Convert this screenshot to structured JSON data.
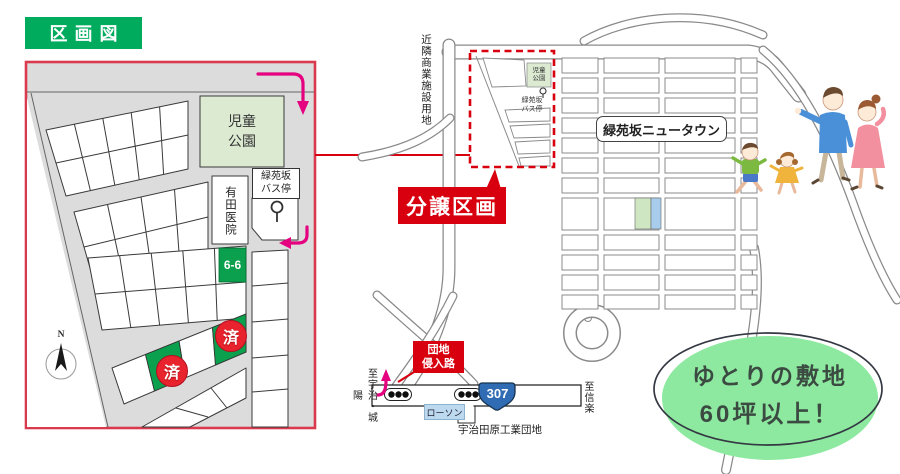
{
  "badge": {
    "label": "区画図"
  },
  "lot_map": {
    "park": "児童\n公園",
    "bus_stop": "緑苑坂\nバス停",
    "clinic": "有田医院",
    "lot_number": "6-6",
    "sold": "済",
    "compass_n": "N"
  },
  "area_map": {
    "commercial_land": "近隣商業施設用地",
    "park_small": "児童\n公園",
    "bus_stop_small": "緑苑坂\nバス停",
    "newtown": "緑苑坂ニュータウン",
    "sale_section": "分譲区画",
    "entrance_road": "団地\n侵入路",
    "to_uji": "至宇治・城陽",
    "to_shigaraki": "至信楽",
    "route_number": "307",
    "lawson": "ローソン",
    "industrial_park": "宇治田原工業団地"
  },
  "promo": {
    "line1": "ゆとりの敷地",
    "line2": "60坪以上！"
  },
  "colors": {
    "badge_green": "#00ab5e",
    "map_border_red": "#d93a4e",
    "accent_red": "#d8000f",
    "magenta": "#e4007f",
    "sold_green": "#0aa04e",
    "sold_circle_red": "#e8232d",
    "park_green": "#dcead2",
    "route_blue": "#2f6cb3",
    "lawson_blue": "#bcd9ef",
    "promo_green": "#8ee9a0"
  }
}
